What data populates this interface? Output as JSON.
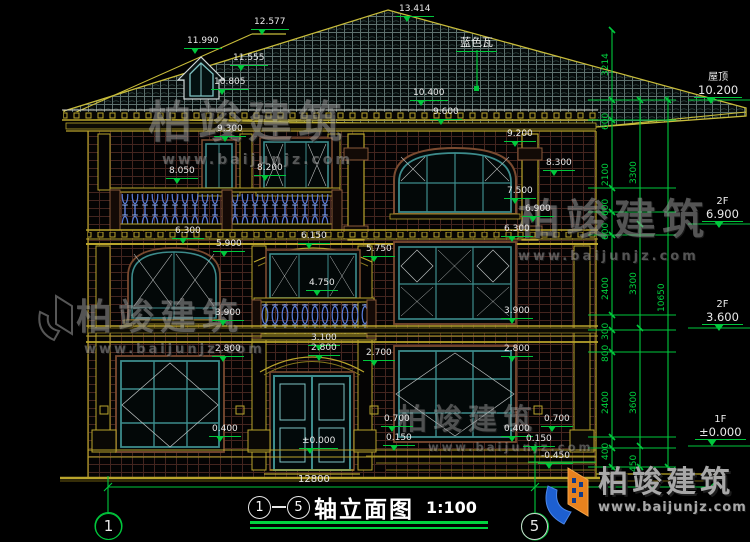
{
  "watermark": {
    "name": "柏竣建筑",
    "url": "www.baijunjz.com"
  },
  "roof_note": {
    "t": "蓝色瓦",
    "x": 456,
    "y": 34
  },
  "levels": [
    {
      "t": "13.414",
      "x": 396,
      "y": 4
    },
    {
      "t": "12.577",
      "x": 251,
      "y": 17
    },
    {
      "t": "11.990",
      "x": 184,
      "y": 36
    },
    {
      "t": "11.555",
      "x": 230,
      "y": 53
    },
    {
      "t": "10.805",
      "x": 211,
      "y": 77
    },
    {
      "t": "10.400",
      "x": 410,
      "y": 88
    },
    {
      "t": "9.600",
      "x": 430,
      "y": 107
    },
    {
      "t": "9.300",
      "x": 214,
      "y": 124
    },
    {
      "t": "9.200",
      "x": 504,
      "y": 129
    },
    {
      "t": "8.300",
      "x": 543,
      "y": 158
    },
    {
      "t": "8.200",
      "x": 254,
      "y": 163
    },
    {
      "t": "8.050",
      "x": 166,
      "y": 166
    },
    {
      "t": "7.500",
      "x": 504,
      "y": 186
    },
    {
      "t": "6.900",
      "x": 522,
      "y": 204
    },
    {
      "t": "6.300",
      "x": 501,
      "y": 224
    },
    {
      "t": "6.300",
      "x": 172,
      "y": 226
    },
    {
      "t": "6.150",
      "x": 298,
      "y": 231
    },
    {
      "t": "5.900",
      "x": 213,
      "y": 239
    },
    {
      "t": "5.750",
      "x": 363,
      "y": 244
    },
    {
      "t": "4.750",
      "x": 306,
      "y": 278
    },
    {
      "t": "3.900",
      "x": 212,
      "y": 308
    },
    {
      "t": "3.900",
      "x": 501,
      "y": 306
    },
    {
      "t": "3.100",
      "x": 308,
      "y": 333
    },
    {
      "t": "2.800",
      "x": 212,
      "y": 344
    },
    {
      "t": "2.800",
      "x": 308,
      "y": 343
    },
    {
      "t": "2.800",
      "x": 501,
      "y": 344
    },
    {
      "t": "2.700",
      "x": 363,
      "y": 348
    },
    {
      "t": "0.700",
      "x": 381,
      "y": 414
    },
    {
      "t": "0.700",
      "x": 541,
      "y": 414
    },
    {
      "t": "0.400",
      "x": 209,
      "y": 424
    },
    {
      "t": "0.400",
      "x": 501,
      "y": 424
    },
    {
      "t": "0.150",
      "x": 383,
      "y": 433
    },
    {
      "t": "0.150",
      "x": 523,
      "y": 434
    },
    {
      "t": "±0.000",
      "x": 299,
      "y": 436
    },
    {
      "t": "-0.450",
      "x": 538,
      "y": 451
    }
  ],
  "vdims": [
    {
      "t": "3214",
      "x": 601,
      "y": 76
    },
    {
      "t": "600",
      "x": 601,
      "y": 130
    },
    {
      "t": "2100",
      "x": 601,
      "y": 186
    },
    {
      "t": "600",
      "x": 601,
      "y": 216
    },
    {
      "t": "600",
      "x": 601,
      "y": 240
    },
    {
      "t": "2400",
      "x": 601,
      "y": 300
    },
    {
      "t": "300",
      "x": 601,
      "y": 340
    },
    {
      "t": "800",
      "x": 601,
      "y": 362
    },
    {
      "t": "2400",
      "x": 601,
      "y": 414
    },
    {
      "t": "400",
      "x": 601,
      "y": 460
    },
    {
      "t": "3300",
      "x": 629,
      "y": 184
    },
    {
      "t": "3300",
      "x": 629,
      "y": 295
    },
    {
      "t": "3600",
      "x": 629,
      "y": 414
    },
    {
      "t": "450",
      "x": 629,
      "y": 472
    },
    {
      "t": "10650",
      "x": 657,
      "y": 312
    }
  ],
  "rmarkers": [
    {
      "l": "屋顶",
      "v": "10.200",
      "x": 694,
      "y": 72
    },
    {
      "l": "2F",
      "v": "6.900",
      "x": 702,
      "y": 196
    },
    {
      "l": "2F",
      "v": "3.600",
      "x": 702,
      "y": 299
    },
    {
      "l": "1F",
      "v": "±0.000",
      "x": 695,
      "y": 414
    }
  ],
  "bottom": {
    "overall_dim": "12800",
    "axis_left": "1",
    "axis_right": "5"
  },
  "title": {
    "axis_from": "1",
    "axis_to": "5",
    "name": "轴立面图",
    "scale": "1:100"
  },
  "colors": {
    "dim_green": "#00c83c",
    "trim_yellow": "#b9a42c",
    "frame_teal": "#3d8c8c",
    "baluster_blue": "#5a7fe0",
    "logo_orange": "#e8821e",
    "logo_blue": "#1d5fd0"
  }
}
